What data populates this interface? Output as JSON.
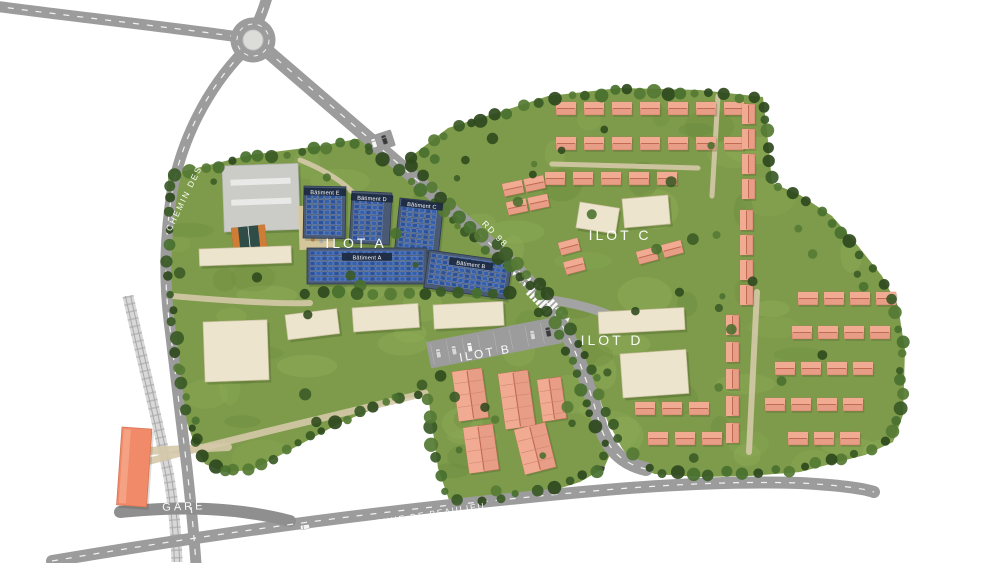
{
  "plan": {
    "ilot_labels": {
      "a": "ILOT A",
      "b": "ILOT B",
      "c": "ILOT C",
      "d": "ILOT D"
    },
    "road_labels": {
      "chemin": "CHEMIN DES LAUGIERS",
      "rd": "RD 98",
      "avenue": "AVENUE DE BEAULIEU",
      "gare": "GARE"
    },
    "building_labels": {
      "a": "Bâtiment A",
      "b": "Bâtiment B",
      "c": "Bâtiment C",
      "d": "Bâtiment D",
      "e": "Bâtiment E"
    }
  },
  "colors": {
    "bg": "#ffffff",
    "green": "#7d9b4a",
    "green_light": "#8fac58",
    "green_dark": "#6b8a3e",
    "tree_dark": "#3a5a26",
    "tree_mid": "#48702e",
    "tree_deep": "#2e491d",
    "road": "#9c9c9c",
    "road_dark": "#8f8f8f",
    "road_line": "#ffffff",
    "rail": "#d8d8d8",
    "rail_tie": "#b9b9b9",
    "path_beige": "#d5c9a8",
    "cream": "#ece4cd",
    "cream_edge": "#cbbf9f",
    "salmon": "#e79d86",
    "salmon_roof": "#f0ab92",
    "salmon_ridge": "#bf6a52",
    "solar": "#3560ae",
    "solar_alt": "#2c529c",
    "slab": "#4a5a74",
    "slab_edge": "#2e3a50",
    "banner": "#1d2a40",
    "school": "#cbcbc8",
    "station": "#f08a68",
    "court": "#2f4c47",
    "court_accent": "#cf7d36",
    "island": "#dcdcd9",
    "car_dark": "#3a3a3a",
    "car_white": "#f5f5f5",
    "label": "#ffffff"
  }
}
